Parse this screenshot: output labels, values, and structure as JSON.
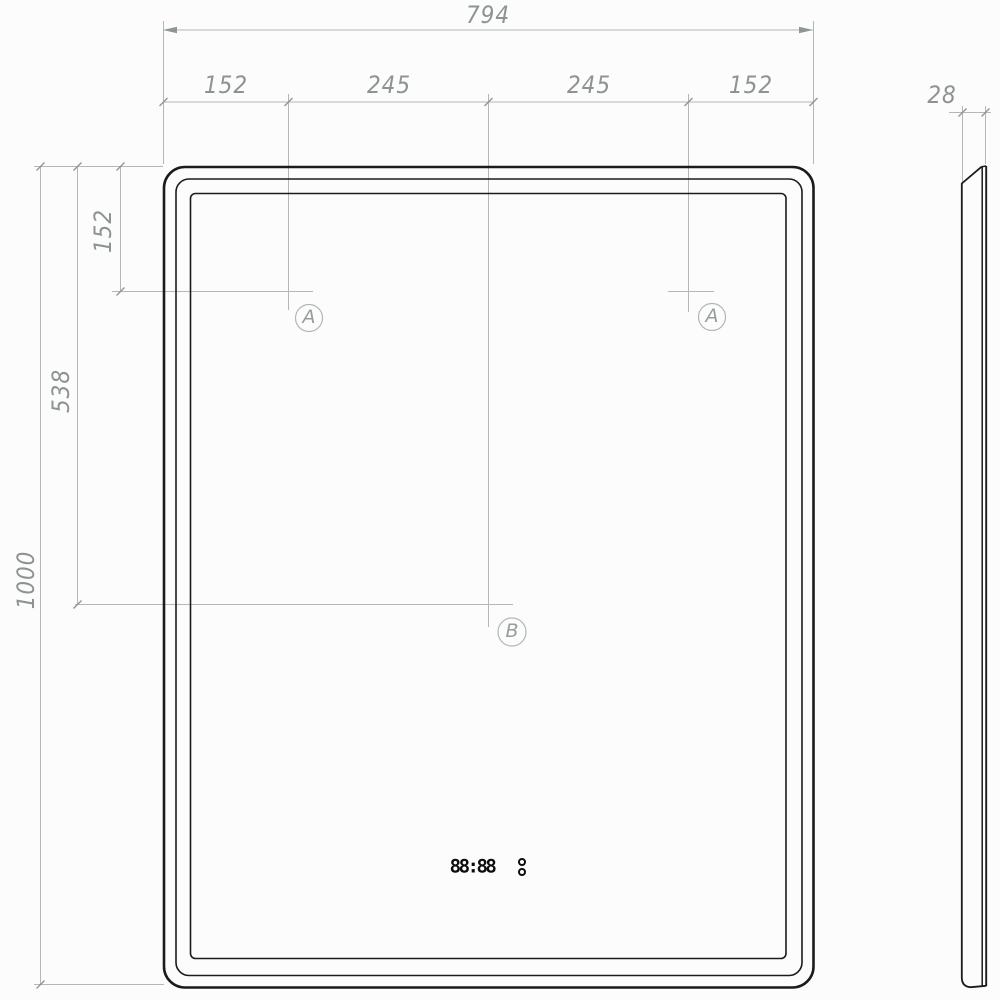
{
  "meta": {
    "drawing_type": "technical dimension drawing",
    "subject": "rectangular LED mirror with digital clock, front and side views"
  },
  "colors": {
    "object_line": "#1b1b1b",
    "dimension_line": "#b3b8b7",
    "tick_mark": "#8f9494",
    "dimension_text": "#8d9392",
    "background": "#fcfcfd"
  },
  "front_view": {
    "dim_overall_width": "794",
    "dim_seg_1": "152",
    "dim_seg_2": "245",
    "dim_seg_3": "245",
    "dim_seg_4": "152",
    "dim_hole_offset_top": "152",
    "dim_display_offset_top": "538",
    "dim_overall_height": "1000",
    "marker_hole_left": "A",
    "marker_hole_right": "A",
    "marker_display": "B",
    "clock_display": "88:88"
  },
  "side_view": {
    "dim_depth": "28"
  }
}
